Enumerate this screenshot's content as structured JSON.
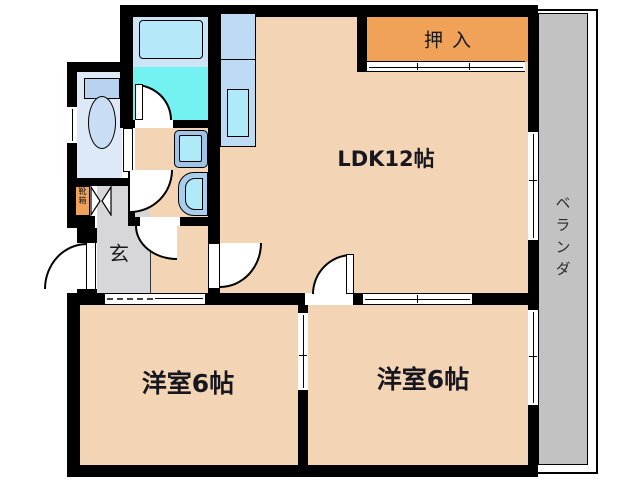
{
  "plan": {
    "title": "apartment-floor-plan",
    "labels": {
      "closet": "押入",
      "ldk": "LDK12帖",
      "veranda": "ベランダ",
      "bedroom1": "洋室6帖",
      "bedroom2": "洋室6帖",
      "entrance": "玄",
      "shoe_cabinet": "靴箱"
    },
    "colors": {
      "floor_peach": "#f3d5b5",
      "closet_orange": "#f0a258",
      "veranda_gray": "#c2c2c2",
      "entrance_gray": "#d7d7d9",
      "bath_cyan": "#74f1f1",
      "bath_deck_blue": "#cde3f6",
      "tub_blue": "#b5e9f9",
      "counter_blue": "#bedbf5",
      "sink_cyan": "#aeeaf8",
      "toilet_floor_blue": "#dde9f7",
      "fixture_blue": "#b7d3ef",
      "wall_black": "#000000"
    },
    "fixtures": [
      "bathtub",
      "bath-door",
      "toilet",
      "toilet-window",
      "washing-machine",
      "washbasin",
      "kitchen-counter",
      "kitchen-sink",
      "shoe-cabinet",
      "folding-door",
      "front-door",
      "closet-sliding-door",
      "veranda-window",
      "room-sliding-door"
    ]
  }
}
